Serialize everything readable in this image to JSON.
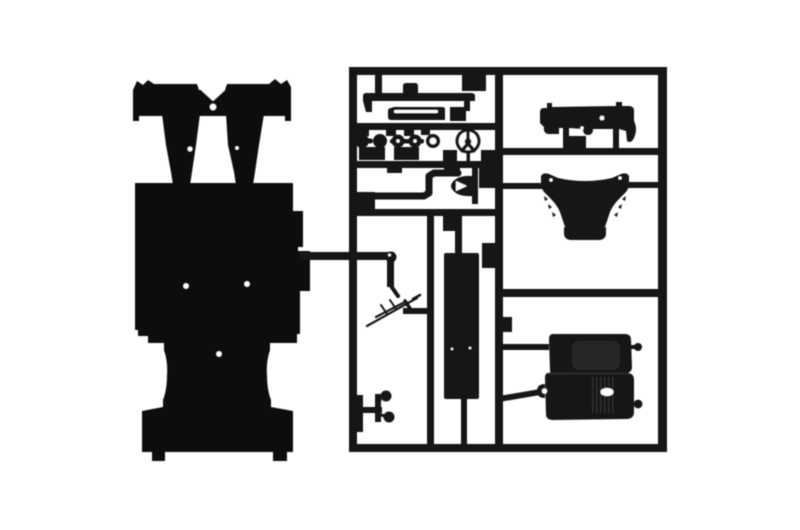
{
  "image": {
    "type": "product-photo",
    "subject": "Unassembled black plastic model kit: car chassis plate with suspension struts beside a parts sprue frame",
    "background_color": "#ffffff",
    "plastic_color": "#151515",
    "plastic_dark": "#0f0f0f",
    "plastic_soft": "#262626",
    "highlight_color": "#ffffff"
  },
  "parts_catalog": [
    "chassis-plate",
    "suspension-struts",
    "sprue-frame",
    "axle-brace",
    "side-sill",
    "wheel-hubs",
    "bushing-ring",
    "steering-wheel",
    "exhaust-link",
    "intake-horn",
    "floor-panel",
    "wiring-lines",
    "pedal-assembly",
    "dashboard-bulkhead",
    "engine-cowl",
    "double-bucket-seat",
    "mounting-knobs"
  ],
  "scene": {
    "width": 800,
    "height": 530,
    "shapes": [
      {
        "name": "chassis-axle-bar",
        "type": "path",
        "fill": "#0f0f0f",
        "d": "M133,121 L133,90 L137,81 L143,85 L148,80 L154,84 L197,84 L199,90 L225,90 L227,84 L269,84 L275,79 L281,84 L287,80 L291,87 L291,121 L285,121 L285,116 L139,116 L139,121 Z"
      },
      {
        "name": "chassis-strut-left",
        "type": "path",
        "fill": "#0f0f0f",
        "d": "M162,114 L200,114 L196,145 L192,172 L190,185 L173,185 L171,172 L166,145 Z"
      },
      {
        "name": "chassis-strut-right",
        "type": "path",
        "fill": "#0f0f0f",
        "d": "M226,114 L264,114 L259,145 L255,172 L253,185 L236,185 L234,172 L228,145 Z"
      },
      {
        "name": "chassis-floor-plate",
        "type": "path",
        "fill": "#0f0f0f",
        "d": "M135,183 L293,183 L293,211 L303,211 L303,247 L298,247 L298,251 L310,251 L310,291 L300,291 L300,334 L297,334 L297,343 L270,343 L270,350 Q266,362 267,375 Q267,390 271,400 L271,407 L293,411 L293,452 L287,452 L287,461 L273,461 L273,452 L165,452 L165,461 L152,461 L152,452 L142,452 L142,411 L163,407 L163,400 Q167,390 167,375 Q168,362 164,350 L164,343 L148,343 L148,336 L138,336 L138,330 L135,330 Z"
      },
      {
        "name": "strut-gap-notch",
        "type": "path",
        "fill": "#ffffff",
        "d": "M201,90 L225,90 L213,101 Z"
      },
      {
        "name": "bridge-hole",
        "type": "circle",
        "fill": "#ffffff",
        "cx": 213,
        "cy": 107,
        "r": 3.2
      },
      {
        "name": "strut-left-speck",
        "type": "circle",
        "fill": "#ffffff",
        "cx": 190,
        "cy": 149,
        "r": 2.4
      },
      {
        "name": "strut-right-speck",
        "type": "circle",
        "fill": "#ffffff",
        "cx": 237,
        "cy": 148,
        "r": 1.7
      },
      {
        "name": "floor-hole-left",
        "type": "circle",
        "fill": "#ffffff",
        "cx": 186,
        "cy": 286,
        "r": 2.7
      },
      {
        "name": "floor-hole-right",
        "type": "circle",
        "fill": "#ffffff",
        "cx": 247,
        "cy": 284,
        "r": 2.7
      },
      {
        "name": "floor-hole-bottom",
        "type": "circle",
        "fill": "#ffffff",
        "cx": 219,
        "cy": 354,
        "r": 2.7
      },
      {
        "name": "sprue-left-rail",
        "type": "rect",
        "x": 349,
        "y": 67,
        "w": 8,
        "h": 385
      },
      {
        "name": "sprue-right-rail",
        "type": "rect",
        "x": 658,
        "y": 67,
        "w": 9,
        "h": 385
      },
      {
        "name": "sprue-top-rail",
        "type": "rect",
        "x": 349,
        "y": 67,
        "w": 318,
        "h": 8
      },
      {
        "name": "sprue-bottom-rail",
        "type": "rect",
        "x": 349,
        "y": 444,
        "w": 318,
        "h": 8
      },
      {
        "name": "sprue-center-divider",
        "type": "rect",
        "x": 495,
        "y": 67,
        "w": 8,
        "h": 385
      },
      {
        "name": "sprue-h1",
        "type": "rect",
        "x": 353,
        "y": 123,
        "w": 146,
        "h": 7
      },
      {
        "name": "sprue-h2",
        "type": "rect",
        "x": 353,
        "y": 161,
        "w": 146,
        "h": 7
      },
      {
        "name": "sprue-h3",
        "type": "rect",
        "x": 353,
        "y": 209,
        "w": 146,
        "h": 7
      },
      {
        "name": "sprue-v-inner",
        "type": "rect",
        "x": 427,
        "y": 209,
        "w": 7,
        "h": 243
      },
      {
        "name": "sprue-hr1",
        "type": "rect",
        "x": 499,
        "y": 148,
        "w": 163,
        "h": 7
      },
      {
        "name": "sprue-hr2",
        "type": "rect",
        "x": 499,
        "y": 289,
        "w": 163,
        "h": 8
      },
      {
        "name": "cowl-bar-left",
        "type": "rect",
        "x": 499,
        "y": 183,
        "w": 45,
        "h": 6
      },
      {
        "name": "cowl-bar-right",
        "type": "rect",
        "x": 626,
        "y": 182,
        "w": 36,
        "h": 6
      },
      {
        "name": "seat-bar-top",
        "type": "rect",
        "x": 499,
        "y": 344,
        "w": 50,
        "h": 6
      },
      {
        "name": "seat-bar-bottom",
        "type": "path",
        "d": "M499,396 L546,388 L546,394 L499,402 Z"
      },
      {
        "name": "chassis-runner",
        "type": "rect",
        "x": 300,
        "y": 252,
        "w": 92,
        "h": 8
      },
      {
        "name": "runner-drop",
        "type": "rect",
        "x": 387,
        "y": 257,
        "w": 7,
        "h": 30
      },
      {
        "name": "panel-stem-top",
        "type": "rect",
        "x": 455,
        "y": 214,
        "w": 7,
        "h": 40
      },
      {
        "name": "panel-stem-bottom",
        "type": "rect",
        "x": 461,
        "y": 398,
        "w": 6,
        "h": 47
      },
      {
        "name": "antenna-crossbar",
        "type": "rect",
        "x": 403,
        "y": 308,
        "w": 27,
        "h": 6
      },
      {
        "name": "top-cell-stub",
        "type": "rect",
        "x": 375,
        "y": 73,
        "w": 7,
        "h": 22
      },
      {
        "name": "gate-block",
        "type": "rect",
        "x": 462,
        "y": 72,
        "w": 24,
        "h": 19
      },
      {
        "name": "gate-block",
        "type": "rect",
        "x": 450,
        "y": 107,
        "w": 16,
        "h": 14
      },
      {
        "name": "gate-block",
        "type": "rect",
        "x": 357,
        "y": 125,
        "w": 12,
        "h": 11
      },
      {
        "name": "gate-block",
        "type": "rect",
        "x": 386,
        "y": 125,
        "w": 10,
        "h": 11
      },
      {
        "name": "gate-block",
        "type": "rect",
        "x": 404,
        "y": 125,
        "w": 10,
        "h": 11
      },
      {
        "name": "gate-block",
        "type": "rect",
        "x": 421,
        "y": 125,
        "w": 9,
        "h": 10
      },
      {
        "name": "gate-block",
        "type": "rect",
        "x": 359,
        "y": 147,
        "w": 26,
        "h": 13
      },
      {
        "name": "gate-block",
        "type": "rect",
        "x": 394,
        "y": 147,
        "w": 25,
        "h": 13
      },
      {
        "name": "gate-block",
        "type": "rect",
        "x": 443,
        "y": 150,
        "w": 14,
        "h": 12
      },
      {
        "name": "gate-block",
        "type": "rect",
        "x": 481,
        "y": 150,
        "w": 15,
        "h": 12
      },
      {
        "name": "gate-block",
        "type": "rect",
        "x": 356,
        "y": 192,
        "w": 19,
        "h": 18
      },
      {
        "name": "gate-block",
        "type": "rect",
        "x": 387,
        "y": 162,
        "w": 15,
        "h": 11
      },
      {
        "name": "gate-block",
        "type": "rect",
        "x": 444,
        "y": 162,
        "w": 16,
        "h": 11
      },
      {
        "name": "gate-block",
        "type": "rect",
        "x": 479,
        "y": 167,
        "w": 18,
        "h": 21
      },
      {
        "name": "gate-block",
        "type": "rect",
        "x": 443,
        "y": 209,
        "w": 15,
        "h": 22
      },
      {
        "name": "gate-block",
        "type": "rect",
        "x": 482,
        "y": 243,
        "w": 15,
        "h": 25
      },
      {
        "name": "gate-block",
        "type": "rect",
        "x": 567,
        "y": 136,
        "w": 19,
        "h": 12
      },
      {
        "name": "gate-block",
        "type": "rect",
        "x": 499,
        "y": 317,
        "w": 13,
        "h": 15
      },
      {
        "name": "gate-block",
        "type": "rect",
        "x": 351,
        "y": 395,
        "w": 12,
        "h": 37
      },
      {
        "name": "part-axle-brace",
        "type": "path",
        "d": "M363,101 L363,96 Q363,93 366,93 L403,93 L403,86 Q403,83 406,83 L415,83 Q418,83 418,86 L418,93 L471,93 Q475,93 475,96 L475,101 L470,101 L470,111 L464,111 L464,101 L372,101 L372,112 L366,112 Z"
      },
      {
        "name": "part-side-sill",
        "type": "path",
        "d": "M391,108 Q388,108 388,111 L388,117 Q388,120 391,120 L445,120 L445,109 Q445,107 442,107 L394,107 Z"
      },
      {
        "name": "sill-slit",
        "type": "rect",
        "fill": "#ffffff",
        "x": 394,
        "y": 110,
        "w": 44,
        "h": 3,
        "rx": 1.5
      },
      {
        "name": "wheel-hub-1",
        "type": "circle",
        "cx": 362,
        "cy": 141,
        "r": 7
      },
      {
        "name": "hub-axle-12",
        "type": "rect",
        "x": 352,
        "y": 138.5,
        "w": 21,
        "h": 5,
        "rx": 2.5
      },
      {
        "name": "wheel-hub-2",
        "type": "circle",
        "cx": 380,
        "cy": 141,
        "r": 7
      },
      {
        "name": "hub-axle-34",
        "type": "rect",
        "x": 390,
        "y": 139,
        "w": 34,
        "h": 4.5,
        "rx": 2
      },
      {
        "name": "wheel-hub-3",
        "type": "circle",
        "cx": 398,
        "cy": 141,
        "r": 6.5
      },
      {
        "name": "wheel-hub-4",
        "type": "circle",
        "cx": 415,
        "cy": 141,
        "r": 6.5
      },
      {
        "name": "hub3-hole",
        "type": "circle",
        "fill": "#ffffff",
        "cx": 398,
        "cy": 141,
        "r": 1.7
      },
      {
        "name": "hub4-hole",
        "type": "circle",
        "fill": "#ffffff",
        "cx": 415,
        "cy": 141,
        "r": 1.7
      },
      {
        "name": "bushing-ring",
        "type": "circle",
        "cx": 433,
        "cy": 141,
        "r": 7
      },
      {
        "name": "bushing-hole",
        "type": "circle",
        "fill": "#ffffff",
        "cx": 433,
        "cy": 141,
        "r": 3.4
      },
      {
        "name": "steering-wheel-rim",
        "type": "circle",
        "cx": 468,
        "cy": 141,
        "r": 12.5
      },
      {
        "name": "steering-wheel-inner",
        "type": "circle",
        "fill": "#ffffff",
        "cx": 468,
        "cy": 141,
        "r": 9.3
      },
      {
        "name": "steering-spoke-top",
        "type": "rect",
        "x": 466.3,
        "y": 129,
        "w": 3.4,
        "h": 13
      },
      {
        "name": "steering-spoke-left",
        "type": "path",
        "d": "M467,142 L459.5,150.5 L462.5,153 L470,144 Z"
      },
      {
        "name": "steering-spoke-right",
        "type": "path",
        "d": "M469,142 L476.5,150.5 L473.5,153 L466,144 Z"
      },
      {
        "name": "steering-hub",
        "type": "circle",
        "cx": 468,
        "cy": 141.5,
        "r": 3.4
      },
      {
        "name": "steering-stem",
        "type": "rect",
        "x": 466.5,
        "y": 153,
        "w": 3.5,
        "h": 9
      },
      {
        "name": "exhaust-link",
        "type": "path",
        "stroke": true,
        "sw": 7,
        "d": "M358,196 L424,196 L429,193 L429,176 L434,173 L458,173"
      },
      {
        "name": "intake-horn",
        "type": "path",
        "d": "M472,168 L478,168 L478,204 L472,204 L472,196 Q457,197 452,189 Q450,186 452,183 Q457,175 472,176 Z"
      },
      {
        "name": "horn-notch",
        "type": "path",
        "fill": "#ffffff",
        "d": "M456,181 L467,186 L456,191 Z"
      },
      {
        "name": "floor-panel",
        "type": "rect",
        "x": 444,
        "y": 253,
        "w": 35,
        "h": 146,
        "rx": 2
      },
      {
        "name": "panel-speck-1",
        "type": "circle",
        "fill": "#ffffff",
        "cx": 452,
        "cy": 349,
        "r": 1.2
      },
      {
        "name": "panel-speck-2",
        "type": "circle",
        "fill": "#ffffff",
        "cx": 470,
        "cy": 348,
        "r": 1.2
      },
      {
        "name": "runner-joint",
        "type": "circle",
        "cx": 391,
        "cy": 257,
        "r": 5.5
      },
      {
        "name": "joint-glint",
        "type": "circle",
        "fill": "#ffffff",
        "cx": 389.5,
        "cy": 255,
        "r": 1.4
      },
      {
        "name": "runner-elbow",
        "type": "path",
        "stroke": true,
        "sw": 4,
        "d": "M391,286 L398,296"
      },
      {
        "name": "wire-main",
        "type": "path",
        "stroke": true,
        "sw": 2.2,
        "d": "M367,326 L417,298"
      },
      {
        "name": "wire-branch",
        "type": "path",
        "stroke": true,
        "sw": 2.2,
        "d": "M376,317 L403,303"
      },
      {
        "name": "wire-tick-1",
        "type": "path",
        "stroke": true,
        "sw": 2,
        "d": "M387,314 L381,305"
      },
      {
        "name": "wire-tick-2",
        "type": "path",
        "stroke": true,
        "sw": 2,
        "d": "M396,309 L390,300"
      },
      {
        "name": "wire-hook",
        "type": "path",
        "stroke": true,
        "sw": 2.5,
        "d": "M413,299 L420,295"
      },
      {
        "name": "wire-link",
        "type": "path",
        "stroke": true,
        "sw": 3.5,
        "d": "M405,301 L411,310"
      },
      {
        "name": "pedal-bar",
        "type": "rect",
        "x": 359,
        "y": 407,
        "w": 23,
        "h": 6
      },
      {
        "name": "pedal-post",
        "type": "rect",
        "x": 375,
        "y": 394,
        "w": 6,
        "h": 28
      },
      {
        "name": "pedal-pad-top",
        "type": "circle",
        "cx": 386,
        "cy": 396,
        "r": 5.5
      },
      {
        "name": "pedal-stem-top",
        "type": "path",
        "stroke": true,
        "sw": 3,
        "d": "M380,400 L377,406"
      },
      {
        "name": "pedal-pad-bottom",
        "type": "circle",
        "cx": 389,
        "cy": 417,
        "r": 5.5
      },
      {
        "name": "pedal-stem-bottom",
        "type": "path",
        "stroke": true,
        "sw": 3,
        "d": "M381,415 L385,416"
      },
      {
        "name": "dashboard-bulkhead",
        "type": "path",
        "d": "M540,112 Q540,108 544,108 L547,108 L547,103 L552,103 L552,107 L616,106 L616,102 L622,102 L622,106 L629,106 Q634,106 634,111 L634,121 Q638,129 634,138 Q631,144 627,141 L626,131 L619,129 L619,148 L613,148 L613,129 L593,129 Q593,135 588,135 Q583,135 583,129 L569,128 L569,148 L563,148 L563,128 L559,128 L559,134 L549,134 Q543,134 544,127 L540,123 Z"
      },
      {
        "name": "dash-hole",
        "type": "circle",
        "fill": "#ffffff",
        "cx": 602,
        "cy": 118,
        "r": 2.3
      },
      {
        "name": "dash-notch",
        "type": "circle",
        "fill": "#ffffff",
        "cx": 582,
        "cy": 128,
        "r": 1.6
      },
      {
        "name": "engine-cowl",
        "type": "path",
        "d": "M541,176 Q543,172 549,174 L558,178 Q585,184 612,178 L621,174 Q627,172 629,176 L629,183 Q629,189 625,193 L619,199 Q613,205 610,212 L606,224 Q605,228 602,229 Q585,233 568,229 Q565,228 564,224 L560,212 Q557,205 551,199 L545,193 Q541,189 541,183 Z"
      },
      {
        "name": "cowl-lip",
        "type": "path",
        "d": "M564,227 L564,233 Q564,239 570,240 L600,240 Q606,239 606,233 L606,227 Q585,232 564,227 Z"
      },
      {
        "name": "cowl-serration-left",
        "type": "path",
        "d": "M544,196 L548,199 L545,201 Z M548,204 L552,207 L549,209 Z M552,212 L556,215 L553,217 Z"
      },
      {
        "name": "cowl-serration-right",
        "type": "path",
        "d": "M626,196 L622,199 L625,201 Z M622,204 L618,207 L621,209 Z M618,212 L614,215 L617,217 Z"
      },
      {
        "name": "cowl-hole-left",
        "type": "circle",
        "fill": "#ffffff",
        "cx": 551,
        "cy": 180,
        "r": 1.6
      },
      {
        "name": "cowl-hole-right",
        "type": "circle",
        "fill": "#ffffff",
        "cx": 620,
        "cy": 178,
        "r": 1.6
      },
      {
        "name": "seat-upper",
        "type": "path",
        "d": "M553,334 Q549,334 549,339 L550,370 Q550,375 556,375 L625,373 Q632,373 632,367 L631,340 Q631,334 625,334 Z"
      },
      {
        "name": "seat-upper-cushion",
        "type": "rect",
        "fill": "#252525",
        "x": 572,
        "y": 341,
        "w": 48,
        "h": 29,
        "rx": 7
      },
      {
        "name": "seat-lower",
        "type": "path",
        "d": "M548,373 Q545,373 545,378 L546,414 Q546,420 553,420 L626,419 Q634,419 634,412 L634,380 Q634,373 627,373 Z"
      },
      {
        "name": "seat-split-line",
        "type": "rect",
        "fill": "#2c2c2c",
        "x": 549,
        "y": 372.5,
        "w": 80,
        "h": 2
      },
      {
        "name": "seat-ear",
        "type": "path",
        "d": "M545,384 Q537,384 537,391 Q537,398 545,398 Z"
      },
      {
        "name": "seat-ear-hole",
        "type": "circle",
        "fill": "#ffffff",
        "cx": 544.5,
        "cy": 391,
        "r": 2.6
      },
      {
        "name": "seat-ribs",
        "type": "path",
        "fill": "#2e2e2e",
        "d": "M592,377 h1.6 v36 h-1.6 Z M596,377 h1.6 v36 h-1.6 Z M600,377 h1.6 v36 h-1.6 Z M604,377 h1.6 v36 h-1.6 Z M608,377 h1.6 v36 h-1.6 Z M612,377 h1.6 v36 h-1.6 Z"
      },
      {
        "name": "seat-oval-hole",
        "type": "ellipse",
        "fill": "#ffffff",
        "cx": 607,
        "cy": 392,
        "rx": 6.5,
        "ry": 4
      },
      {
        "name": "knob-stem-top",
        "type": "rect",
        "x": 630,
        "y": 345,
        "w": 8,
        "h": 4,
        "rx": 2
      },
      {
        "name": "mounting-knob-top",
        "type": "circle",
        "cx": 638,
        "cy": 347,
        "r": 4
      },
      {
        "name": "knob-stem-bottom",
        "type": "rect",
        "x": 630,
        "y": 402,
        "w": 8,
        "h": 4,
        "rx": 2
      },
      {
        "name": "mounting-knob-bottom",
        "type": "circle",
        "cx": 638,
        "cy": 404,
        "r": 4.4
      }
    ]
  }
}
